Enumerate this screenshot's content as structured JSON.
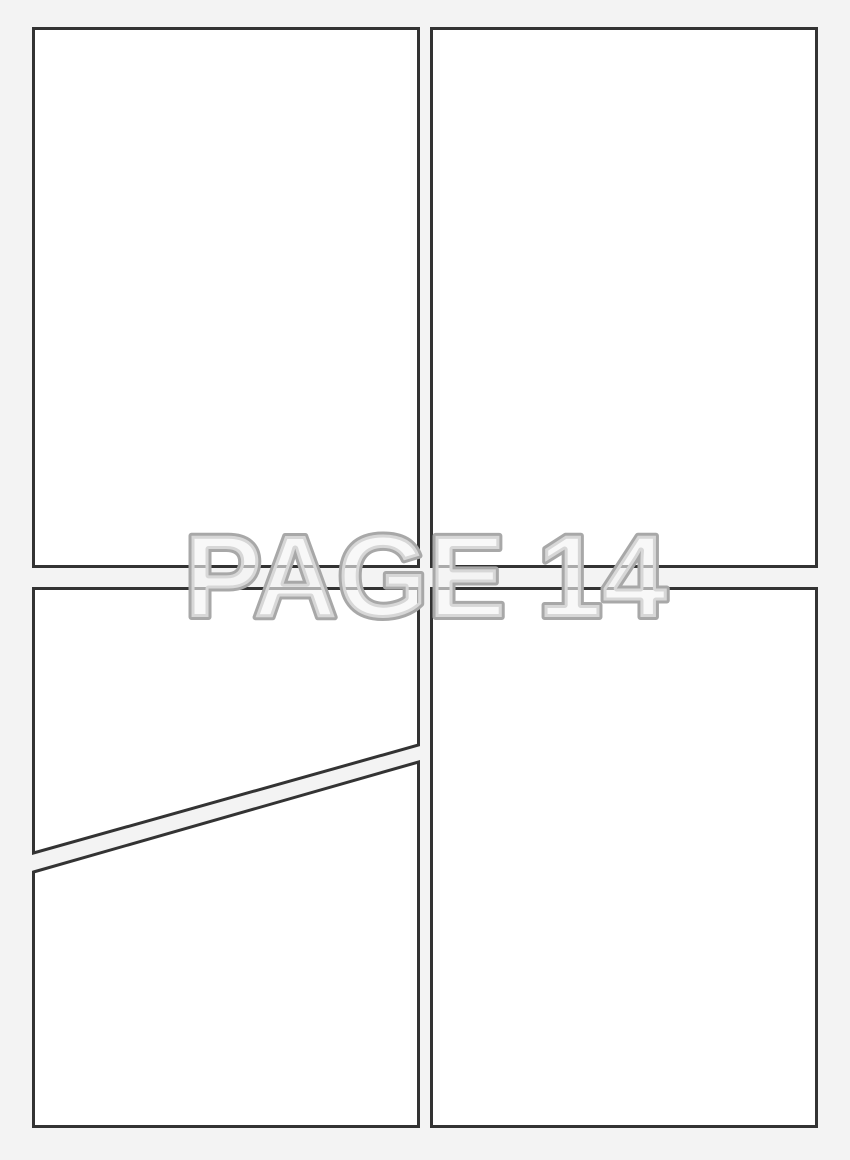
{
  "page": {
    "label": "PAGE 14",
    "colors": {
      "background": "#f3f3f3",
      "panel_fill": "#ffffff",
      "panel_border": "#333333",
      "label_outline": "#a8a8a8",
      "label_fill": "#f3f3f3"
    },
    "panels": [
      {
        "name": "top-left",
        "shape": "rectangle"
      },
      {
        "name": "top-right",
        "shape": "rectangle"
      },
      {
        "name": "middle-left",
        "shape": "rectangle with diagonal bottom edge"
      },
      {
        "name": "bottom-left",
        "shape": "rectangle with diagonal top edge"
      },
      {
        "name": "bottom-right",
        "shape": "rectangle"
      }
    ]
  }
}
